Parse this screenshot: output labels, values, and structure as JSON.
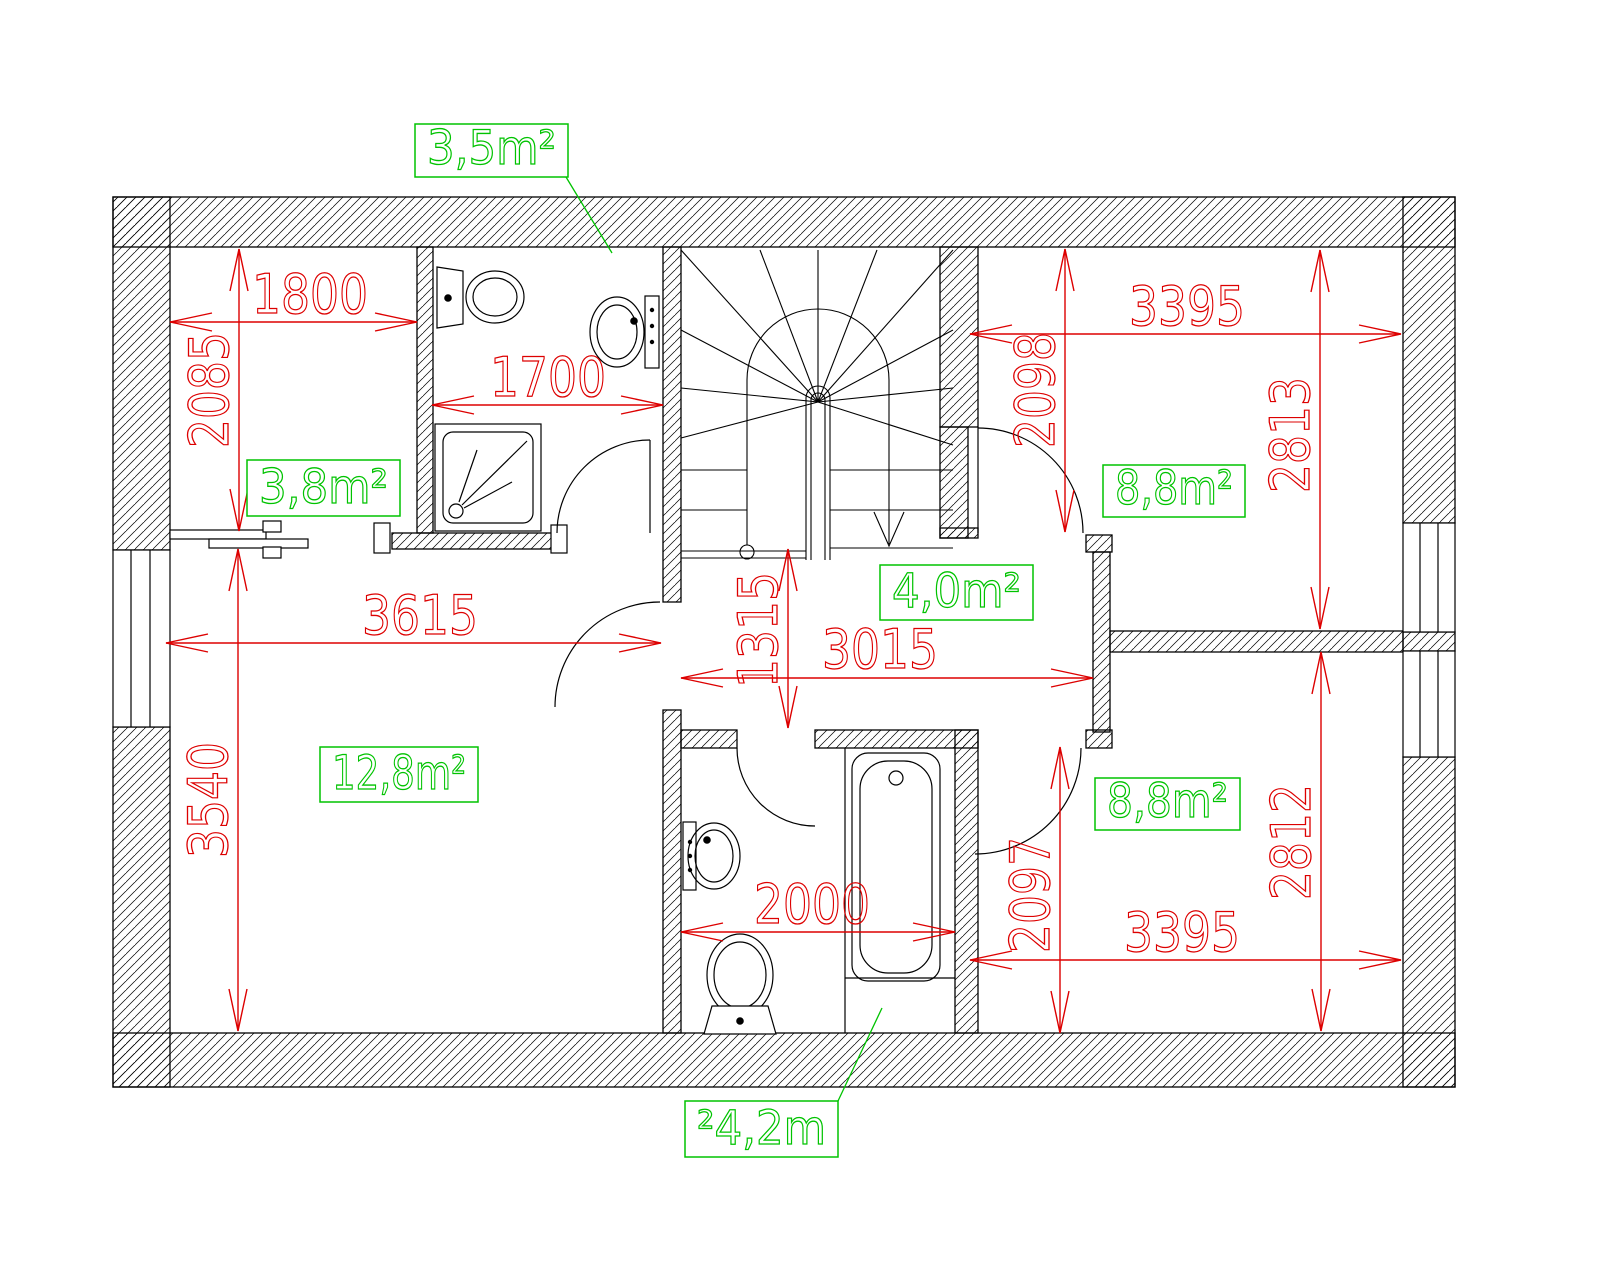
{
  "drawing": {
    "type": "floor-plan",
    "colors": {
      "dimension_red": "#dd0000",
      "label_green": "#00c300",
      "line_black": "#000000",
      "background": "#ffffff"
    },
    "area_labels": [
      {
        "text": "3,5m²",
        "x": 415,
        "y": 124,
        "w": 153,
        "h": 53,
        "leader": [
          566,
          177,
          612,
          253
        ]
      },
      {
        "text": "3,8m²",
        "x": 247,
        "y": 460,
        "w": 153,
        "h": 56
      },
      {
        "text": "4,0m²",
        "x": 880,
        "y": 565,
        "w": 153,
        "h": 55
      },
      {
        "text": "8,8m²",
        "x": 1103,
        "y": 465,
        "w": 142,
        "h": 52
      },
      {
        "text": "8,8m²",
        "x": 1095,
        "y": 778,
        "w": 145,
        "h": 52
      },
      {
        "text": "12,8m²",
        "x": 320,
        "y": 747,
        "w": 158,
        "h": 55
      },
      {
        "text": "²4,2m",
        "x": 685,
        "y": 1101,
        "w": 153,
        "h": 56,
        "leader": [
          838,
          1101,
          882,
          1008
        ]
      }
    ],
    "dimensions": [
      {
        "value": "1800",
        "orient": "h",
        "x1": 170,
        "x2": 417,
        "y": 322,
        "tx": 310,
        "ty": 313
      },
      {
        "value": "2085",
        "orient": "v",
        "y1": 249,
        "y2": 531,
        "x": 239,
        "tx": 228,
        "ty": 390
      },
      {
        "value": "1700",
        "orient": "h",
        "x1": 432,
        "x2": 663,
        "y": 405,
        "tx": 548,
        "ty": 396
      },
      {
        "value": "3395",
        "orient": "h",
        "x1": 970,
        "x2": 1401,
        "y": 334,
        "tx": 1187,
        "ty": 325
      },
      {
        "value": "2098",
        "orient": "v",
        "y1": 249,
        "y2": 532,
        "x": 1065,
        "tx": 1054,
        "ty": 390
      },
      {
        "value": "2813",
        "orient": "v",
        "y1": 250,
        "y2": 629,
        "x": 1320,
        "tx": 1309,
        "ty": 435
      },
      {
        "value": "3615",
        "orient": "h",
        "x1": 166,
        "x2": 661,
        "y": 643,
        "tx": 420,
        "ty": 634
      },
      {
        "value": "3540",
        "orient": "v",
        "y1": 549,
        "y2": 1031,
        "x": 238,
        "tx": 227,
        "ty": 800
      },
      {
        "value": "1315",
        "orient": "v",
        "y1": 549,
        "y2": 728,
        "x": 788,
        "tx": 777,
        "ty": 630
      },
      {
        "value": "3015",
        "orient": "h",
        "x1": 681,
        "x2": 1093,
        "y": 678,
        "tx": 880,
        "ty": 668
      },
      {
        "value": "2000",
        "orient": "h",
        "x1": 681,
        "x2": 955,
        "y": 932,
        "tx": 812,
        "ty": 923
      },
      {
        "value": "2097",
        "orient": "v",
        "y1": 747,
        "y2": 1033,
        "x": 1060,
        "tx": 1049,
        "ty": 895
      },
      {
        "value": "2812",
        "orient": "v",
        "y1": 652,
        "y2": 1031,
        "x": 1321,
        "tx": 1310,
        "ty": 842
      },
      {
        "value": "3395",
        "orient": "h",
        "x1": 970,
        "x2": 1401,
        "y": 960,
        "tx": 1182,
        "ty": 951
      }
    ]
  }
}
